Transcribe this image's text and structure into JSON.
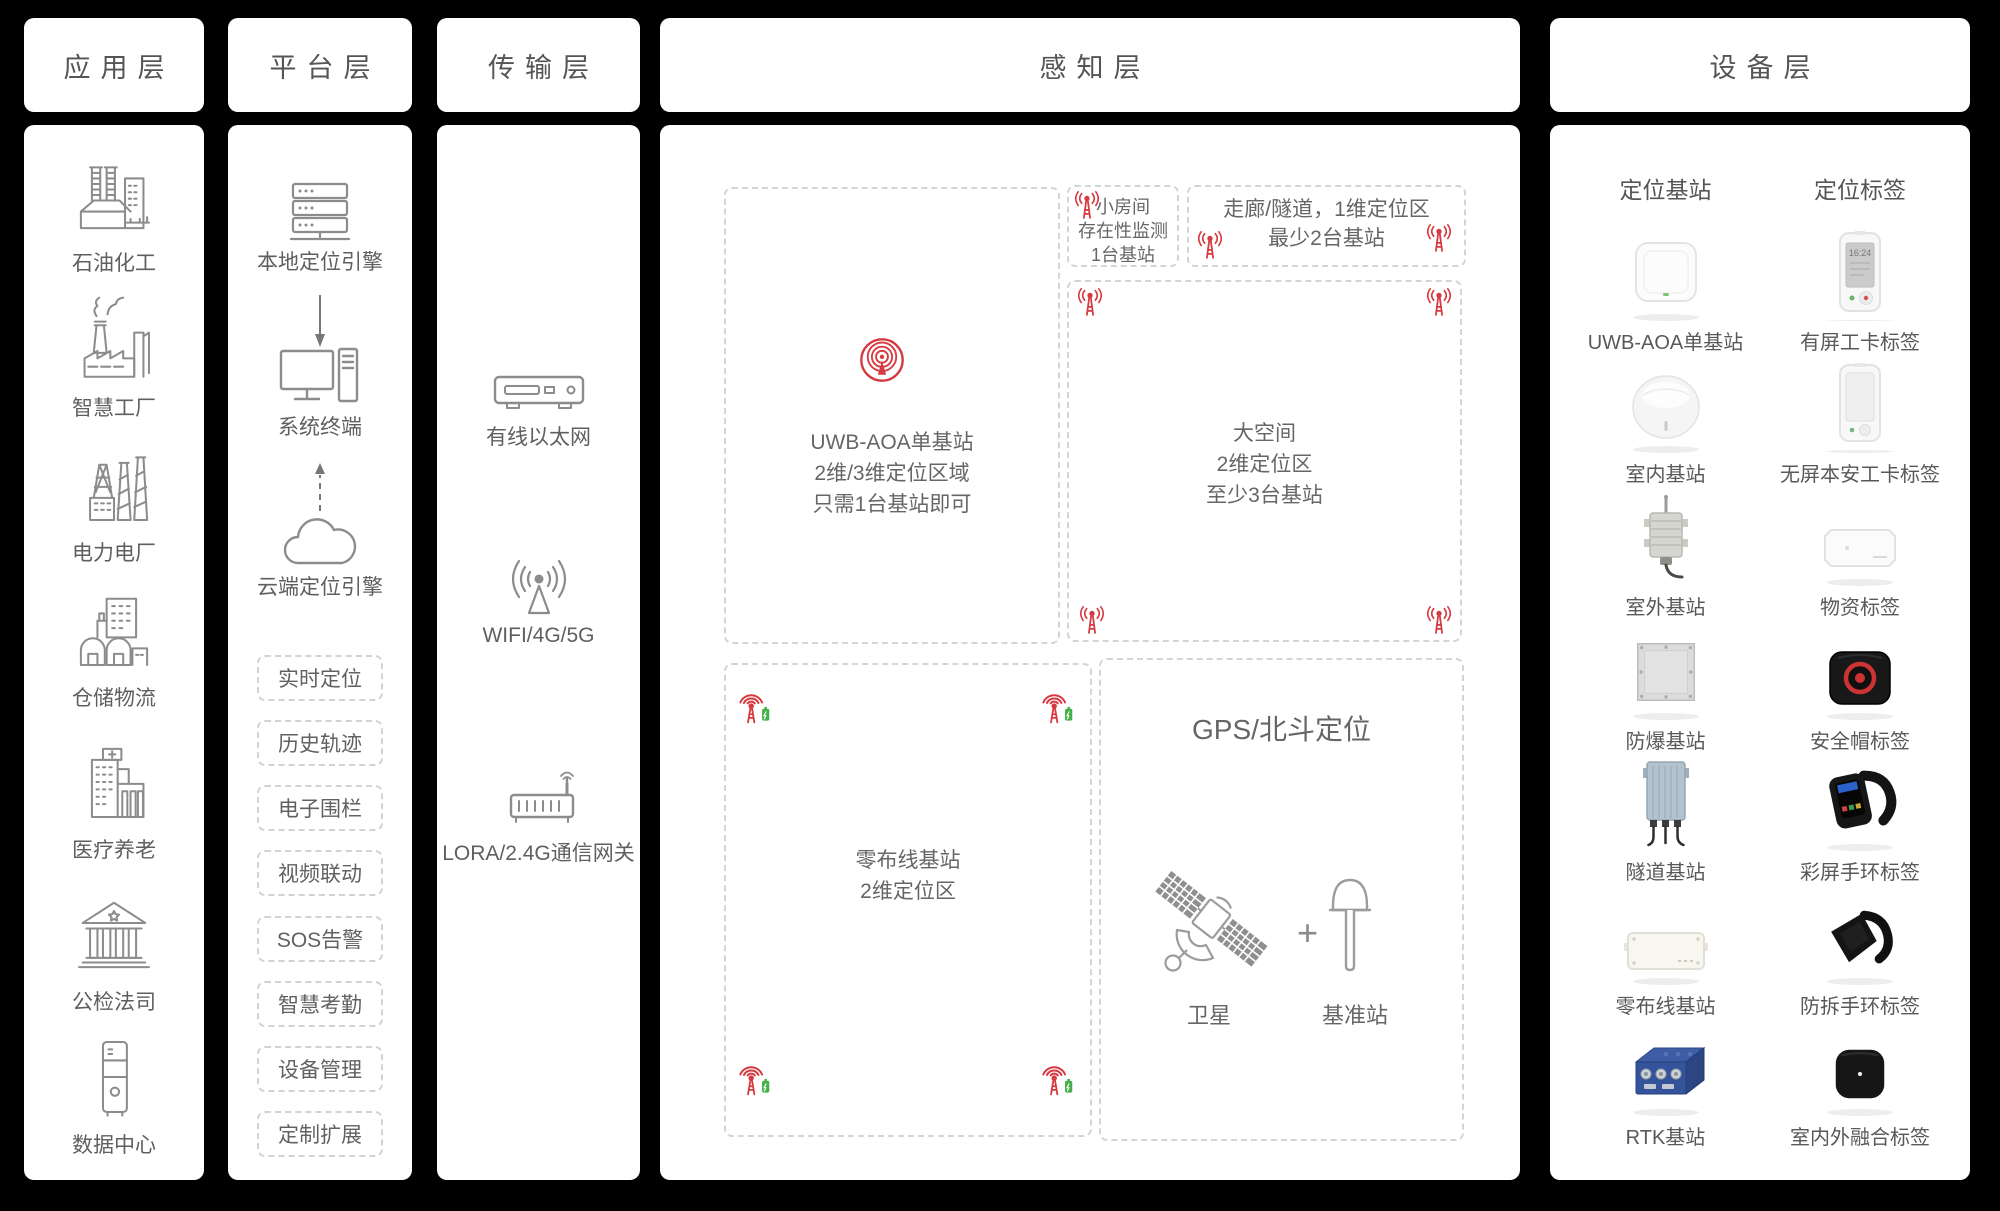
{
  "colors": {
    "background": "#000000",
    "panel": "#ffffff",
    "label_gray": "#5f5f5f",
    "line_icon_gray": "#8c8c8c",
    "dashed_border": "#d4d4d4",
    "accent_red": "#d6393f",
    "battery_green": "#45b04a"
  },
  "header": {
    "application": "应用层",
    "platform": "平台层",
    "transmission": "传输层",
    "perception": "感知层",
    "device": "设备层"
  },
  "application": {
    "items": [
      {
        "label": "石油化工",
        "icon": "refinery-icon"
      },
      {
        "label": "智慧工厂",
        "icon": "smart-factory-icon"
      },
      {
        "label": "电力电厂",
        "icon": "power-plant-icon"
      },
      {
        "label": "仓储物流",
        "icon": "warehouse-logistics-icon"
      },
      {
        "label": "医疗养老",
        "icon": "hospital-icon"
      },
      {
        "label": "公检法司",
        "icon": "courthouse-icon"
      },
      {
        "label": "数据中心",
        "icon": "data-center-icon"
      }
    ]
  },
  "platform": {
    "nodes": {
      "local_engine": "本地定位引擎",
      "terminal": "系统终端",
      "cloud_engine": "云端定位引擎"
    },
    "functions": [
      {
        "label": "实时定位"
      },
      {
        "label": "历史轨迹"
      },
      {
        "label": "电子围栏"
      },
      {
        "label": "视频联动"
      },
      {
        "label": "SOS告警"
      },
      {
        "label": "智慧考勤"
      },
      {
        "label": "设备管理"
      },
      {
        "label": "定制扩展"
      }
    ]
  },
  "transmission": {
    "items": [
      {
        "label": "有线以太网",
        "icon": "ethernet-box-icon"
      },
      {
        "label": "WIFI/4G/5G",
        "icon": "antenna-broadcast-icon"
      },
      {
        "label": "LORA/2.4G通信网关",
        "icon": "gateway-icon"
      }
    ]
  },
  "perception": {
    "zones": {
      "small_room": {
        "lines": [
          "小房间",
          "存在性监测",
          "1台基站"
        ]
      },
      "corridor": {
        "lines": [
          "走廊/隧道，1维定位区",
          "最少2台基站"
        ]
      },
      "uwb": {
        "lines": [
          "UWB-AOA单基站",
          "2维/3维定位区域",
          "只需1台基站即可"
        ]
      },
      "big_space": {
        "lines": [
          "大空间",
          "2维定位区",
          "至少3台基站"
        ]
      },
      "zero_wiring": {
        "lines": [
          "零布线基站",
          "2维定位区"
        ]
      },
      "gps": {
        "title": "GPS/北斗定位",
        "satellite_label": "卫星",
        "plus_sign": "+",
        "base_station_label": "基准站"
      }
    }
  },
  "device": {
    "columns": {
      "stations": "定位基站",
      "tags": "定位标签"
    },
    "badge_time": "16:24",
    "rows": [
      {
        "station": "UWB-AOA单基站",
        "tag": "有屏工卡标签"
      },
      {
        "station": "室内基站",
        "tag": "无屏本安工卡标签"
      },
      {
        "station": "室外基站",
        "tag": "物资标签"
      },
      {
        "station": "防爆基站",
        "tag": "安全帽标签"
      },
      {
        "station": "隧道基站",
        "tag": "彩屏手环标签"
      },
      {
        "station": "零布线基站",
        "tag": "防拆手环标签"
      },
      {
        "station": "RTK基站",
        "tag": "室内外融合标签"
      }
    ]
  }
}
